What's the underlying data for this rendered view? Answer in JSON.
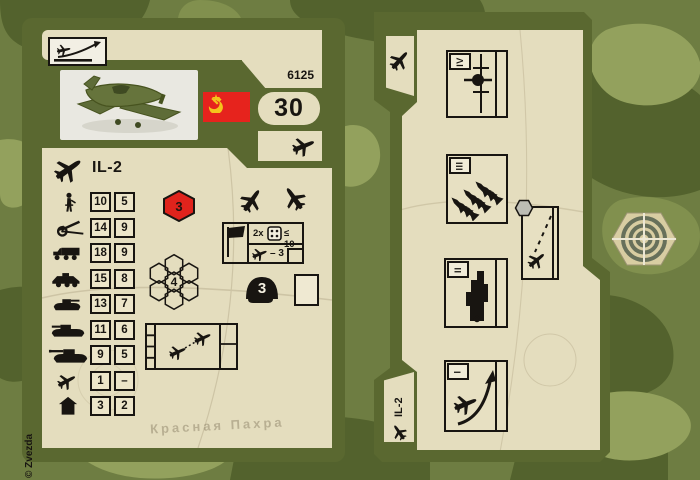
{
  "left_card": {
    "product_code": "6125",
    "point_value": "30",
    "unit_name": "IL-2",
    "initiative_hex": "3",
    "movement_hex": "4",
    "helmet_value": "3",
    "dogfight_box": {
      "multiplier": "2x",
      "dice_limit": "≤ 10",
      "modifier": "– 3"
    },
    "copyright": "© Zvezda",
    "map_label": "Красная Пахра",
    "stats": {
      "rows": [
        {
          "unit": "infantry",
          "v1": "10",
          "v2": "5"
        },
        {
          "unit": "artillery",
          "v1": "14",
          "v2": "9"
        },
        {
          "unit": "truck",
          "v1": "18",
          "v2": "9"
        },
        {
          "unit": "armored-car",
          "v1": "15",
          "v2": "8"
        },
        {
          "unit": "light-tank",
          "v1": "13",
          "v2": "7"
        },
        {
          "unit": "medium-tank",
          "v1": "11",
          "v2": "6"
        },
        {
          "unit": "heavy-tank",
          "v1": "9",
          "v2": "5"
        },
        {
          "unit": "aircraft",
          "v1": "1",
          "v2": "–"
        },
        {
          "unit": "building",
          "v1": "3",
          "v2": "2"
        }
      ]
    }
  },
  "right_card": {
    "unit_name": "IL-2",
    "orders": [
      {
        "numeral": "IV",
        "icon": "flight-path"
      },
      {
        "numeral": "III",
        "icon": "rocket-salvo"
      },
      {
        "numeral": "II",
        "icon": "ground-vehicle-attack"
      },
      {
        "numeral": "I",
        "icon": "takeoff"
      }
    ],
    "strike_box_icon": "diving-attack"
  },
  "icons": {
    "climb": "climb-rate-icon",
    "plane": "aircraft-icon",
    "flag": "flag-icon",
    "dice": "die-icon",
    "helmet": "helmet-icon",
    "target": "target-token",
    "hex_flower": "movement-hexes-icon"
  },
  "colors": {
    "card_olive": "#5a6830",
    "paper": "#e4ddbe",
    "flag_red": "#e6231d",
    "hex_red": "#e0231c",
    "ink": "#181511",
    "token_tan": "#d8cda2",
    "camo_dark": "#53622d",
    "camo_light": "#93a15d"
  }
}
